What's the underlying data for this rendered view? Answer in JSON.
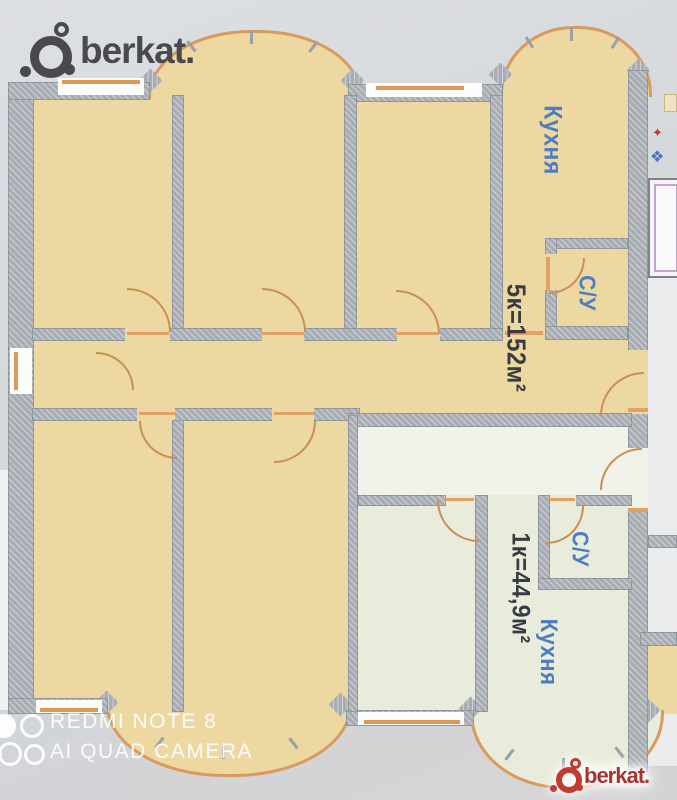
{
  "watermarks": {
    "berkat_top": {
      "text": "berkat."
    },
    "berkat_bottom": {
      "text": "berkat."
    },
    "camera": {
      "line1": "REDMI NOTE 8",
      "line2": "AI QUAD CAMERA"
    }
  },
  "floor_plan": {
    "apartment_5k": {
      "area_label": "5к=152м²",
      "kitchen_label": "Кухня",
      "bathroom_label": "С/У"
    },
    "apartment_1k": {
      "area_label": "1к=44,9м²",
      "kitchen_label": "Кухня",
      "bathroom_label": "С/У"
    },
    "colors": {
      "apartment_5k_fill": "#ecd8a0",
      "apartment_1k_fill": "#e9ecda",
      "wall": "#a8adb4",
      "door_window_accent": "#d89a5e",
      "room_label_blue": "#4c7cc3",
      "area_text": "#363b44",
      "berkat_dark": "#4a4a4c",
      "berkat_red": "#c23b33"
    }
  }
}
